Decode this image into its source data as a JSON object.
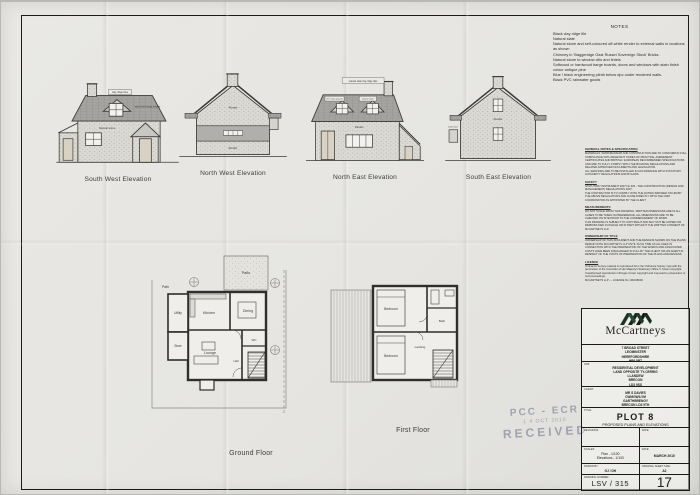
{
  "notes": {
    "title": "NOTES",
    "lines": [
      "Black clay ridge tile",
      "Natural slate",
      "Natural stone and self-coloured off-white render to external walls in locations as shown",
      "Chimney in 'Baggeridge Oast Russet Sovereign Stock' Bricks.",
      "Natural stone to window cills and lintels",
      "Softwood or hardwood barge boards,  doors and windows with stain finish colour antique pine",
      "Blue / black engineering plinth below dpc under rendered walls.",
      "Black PVC rainwater goods"
    ]
  },
  "elevations": {
    "sw": {
      "label": "South West Elevation",
      "ann_ridge": "clay ridge tiles",
      "ann_board": "stain finish barge boards",
      "ann_stone": "Natural stone"
    },
    "nw": {
      "label": "North West Elevation",
      "ann_render1": "Render",
      "ann_render2": "Render"
    },
    "ne": {
      "label": "North East Elevation",
      "ann_top": "natural slate clay ridge tiles",
      "ann_solar": "2m² solar panels",
      "ann_slate": "natural slate",
      "ann_render": "Render"
    },
    "se": {
      "label": "South East Elevation",
      "ann_meter": "meter box",
      "ann_render": "Render"
    }
  },
  "plans": {
    "ground": {
      "label": "Ground Floor",
      "rooms": {
        "patio": "Patio",
        "path": "Path",
        "utility": "Utility",
        "store": "Store",
        "kitchen": "Kitchen",
        "dining": "Dining",
        "lounge": "Lounge",
        "hall": "Hall",
        "wc": "WC"
      }
    },
    "first": {
      "label": "First Floor",
      "rooms": {
        "bed1": "Bedroom",
        "bed2": "Bedroom",
        "bath": "Bath",
        "landing": "Landing"
      }
    }
  },
  "spec": {
    "sections": [
      {
        "heading": "GENERAL NOTES & SPECIFICATION",
        "body": "MATERIALS, WORKMANSHIP AND CONSTRUCTION ARE TO CONFORM IN FULL COMPLIANCE WITH RELEVANT CODES OF PRACTICE, AGREEMENT CERTIFICATES AND BRITISH / EUROPEAN RECOMMENDED SPECIFICATIONS AND ARE TO FULLY COMPLY WITH THE BUILDING REGULATIONS AND RELATED APPROVED DOCUMENTS AND LEGISLATION.\nALL SERVICES ARE TO BE INSTALLED IN ACCORDANCE WITH STATUTORY AUTHORITY REGULATIONS AND BYLAWS."
      },
      {
        "heading": "SAFETY",
        "body": "STATUTORY INSTRUMENT 2007 No 320 - THE CONSTRUCTION (DESIGN AND MANAGEMENT) REGULATIONS 2007.\nTHE CONTRACTOR IS TO COMPLY WITH THE DUTIES IMPOSED ON HIM BY THE ABOVE REGULATIONS AND LIAISE DIRECTLY WITH THE CDM COORDINATOR AS APPOINTED BY THE CLIENT."
      },
      {
        "heading": "MEASUREMENTS",
        "body": "DO NOT SCALE FROM THIS DRAWING. WRITTEN DIMENSIONS ARE IN ALL CASES TO BE TAKEN IN PREFERENCE. ALL DIMENSIONS ARE TO BE CHECKED ON SITE PRIOR TO THE COMMENCEMENT OF WORK.\nTHIS DRAWING IS SUBJECT TO COPYRIGHT AND MAY NOT BE COPIED OR REPRODUCED IN WHOLE OR IN PART WITHOUT THE WRITTEN CONSENT OF McCARTNEYS LLP."
      },
      {
        "heading": "OWNERSHIP OF TITLE",
        "body": "OWNERSHIP OF THIS DOCUMENT AND THE DESIGNS SHOWN ON THE PLANS REMAIN WITH McCARTNEYS LLP UNTIL SUCH TIME AS ALL FEES IN CONNECTION WITH THE PREPARATION OF THE WORKS AND ASSOCIATED COSTS HAVE BEEN DISCHARGED IN FULL BY THE CLIENT OR HIS AGENT IN RESPECT OF THE COSTS OF PREPARATION OF THE PLANS AND DESIGNS."
      },
      {
        "heading": "LICENCE",
        "body": "Ordnance Survey material is reproduced from the Ordnance Survey map with the permission of the Controller of Her Majesty's Stationery Office © Crown copyright. Unauthorised reproduction infringes Crown copyright and may lead to prosecution or civil proceedings.\nMcCARTNEYS LLP — LICENCE No 100018049"
      }
    ]
  },
  "stamp": {
    "line1": "PCC - ECR",
    "line2": "1 4 OCT 2010",
    "line3": "RECEIVED"
  },
  "title_block": {
    "brand": "McCartneys",
    "address": [
      "7 BROAD STREET",
      "LEOMINSTER",
      "HEREFORDSHIRE",
      "HR6 8BT"
    ],
    "job_label": "JOB:",
    "job": [
      "RESIDENTIAL DEVELOPMENT",
      "LAND OPPOSITE TY-CERRIG",
      "LLANDEW",
      "BRECON",
      "LD3 9SS"
    ],
    "client_label": "CLIENT:",
    "client": [
      "MR S DAVIES",
      "CWMGWILYM",
      "GARTHBRENGY",
      "BRECON LD3 9TH"
    ],
    "title_label": "TITLE:",
    "title": "PLOT 8",
    "subtitle": "PROPOSED PLANS AND ELEVATIONS",
    "revisions_label": "REVISIONS:",
    "rev_date_label": "DATE:",
    "scales_label": "SCALES:",
    "scale_plan": "Plan - 1/100",
    "scale_elev": "Elevations - 1/100",
    "date_label": "DATE:",
    "date": "MARCH 2010",
    "drawn_label": "DRAWN BY:",
    "drawn": "GJ / DH",
    "sheet_size_label": "ORIGINAL SHEET SIZE:",
    "sheet_size": "A2",
    "number_label": "DRAWING NUMBER:",
    "number": "LSV / 315",
    "sheet": "17"
  },
  "colors": {
    "paper": "#e7e6e2",
    "ink": "#2e2e2c",
    "roof": "#a5a4a0",
    "stamp": "#7d8096"
  }
}
